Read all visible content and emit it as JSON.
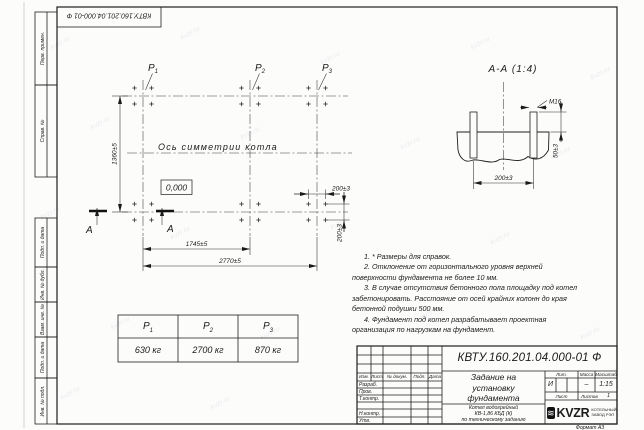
{
  "drawing": {
    "number": "КВТУ.160.201.04.000-01 Ф",
    "format_label": "Формат А3"
  },
  "frame": {
    "side_labels": [
      "Перв. примен.",
      "Справ. №",
      "Подп. и дата",
      "Инв. № дубл.",
      "Взам. инв. №",
      "Подп. и дата",
      "Инв. № подл."
    ]
  },
  "watermark": {
    "text": "kvzr.ru"
  },
  "plan": {
    "axis_label": "Ось симметрии котла",
    "level_mark": "0,000",
    "cut_label": "А",
    "points": [
      {
        "name": "P",
        "sub": "1"
      },
      {
        "name": "P",
        "sub": "2"
      },
      {
        "name": "P",
        "sub": "3"
      }
    ],
    "dims": {
      "height": "1360±5",
      "span_mid": "1745±5",
      "span_full": "2770±5",
      "bolt_spacing_x": "200±3",
      "bolt_spacing_y": "200±3"
    }
  },
  "section": {
    "title": "А-А (1:4)",
    "thread_label": "М16",
    "dims": {
      "protrusion": "50±3",
      "spacing": "200±3"
    }
  },
  "loads_table": {
    "columns": [
      {
        "name": "P",
        "sub": "1",
        "value": "630 кг"
      },
      {
        "name": "P",
        "sub": "2",
        "value": "2700 кг"
      },
      {
        "name": "P",
        "sub": "3",
        "value": "870 кг"
      }
    ]
  },
  "notes": [
    "1. * Размеры для справок.",
    "2. Отклонение от горизонтального уровня верхней поверхности фундамента не более 10 мм.",
    "3. В случае отсутствия бетонного пола площадку под котел забетонировать. Расстояние от осей крайних колонн до края бетонной подушки 500 мм.",
    "4. Фундамент под котел разрабатывает проектная организация по нагрузкам на фундамент."
  ],
  "title_block": {
    "header_cols": [
      "Изм.",
      "Лист",
      "№ докум.",
      "Подп.",
      "Дата"
    ],
    "sig_rows": [
      "Разраб.",
      "Пров.",
      "Т.контр.",
      "",
      "Н.контр.",
      "Утв."
    ],
    "title_lines": [
      "Задание на",
      "установку",
      "фундамента"
    ],
    "product_lines": [
      "Котел водогрейный",
      "КВ-1,86 КБД (К)",
      "по техническому заданию"
    ],
    "lit_header": "Лит.",
    "lit_value": "И",
    "mass_header": "Масса",
    "mass_value": "–",
    "scale_header": "Масштаб",
    "scale_value": "1:15",
    "sheet_label": "Лист",
    "sheets_label": "Листов",
    "sheets_value": "1",
    "logo_icon_glyph": "≋",
    "logo_text": "KVZR",
    "logo_sub1": "КОТЕЛЬНЫЙ",
    "logo_sub2": "ЗАВОД РЭП"
  }
}
